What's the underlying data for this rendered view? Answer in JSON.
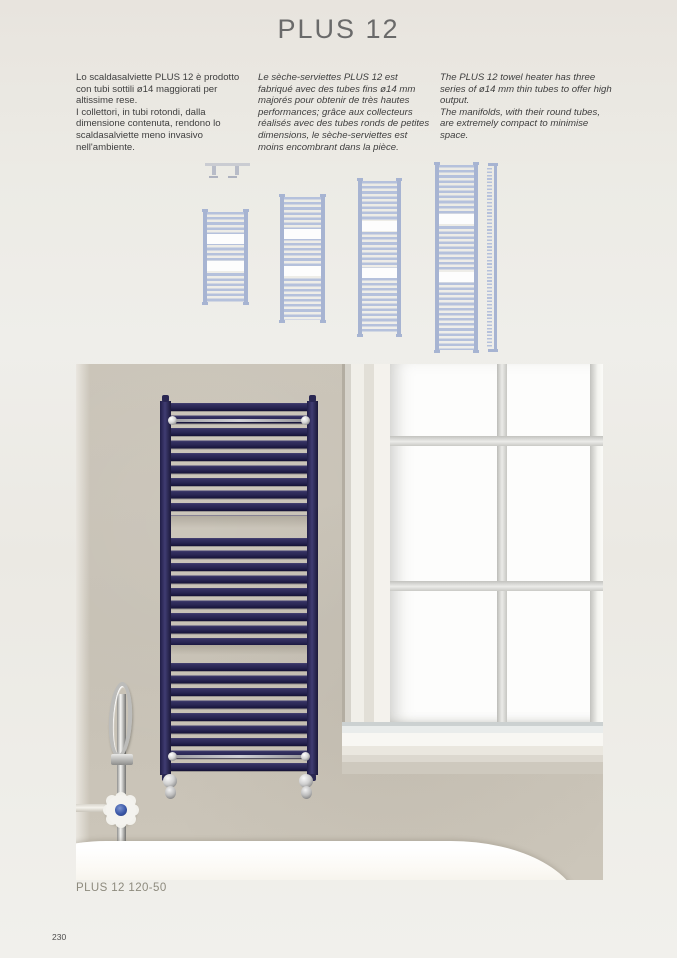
{
  "page": {
    "title": "PLUS 12",
    "caption": "PLUS 12 120-50",
    "page_number": "230"
  },
  "intro": {
    "italian": "Lo scaldasalviette PLUS 12 è prodotto con tubi sottili ø14 maggiorati per altissime rese.\nI collettori, in tubi rotondi, dalla dimensione contenuta, rendono lo scaldasalviette meno invasivo nell'ambiente.",
    "french": "Le sèche-serviettes PLUS 12 est fabriqué avec des tubes fins ø14 mm majorés pour obtenir de très hautes performances; grâce aux collecteurs réalisés avec des tubes ronds de petites dimensions, le sèche-serviettes est moins encombrant dans la pièce.",
    "english": "The PLUS 12 towel heater has three series of ø14 mm thin tubes to offer high output.\nThe manifolds, with their round tubes, are extremely compact to minimise space."
  },
  "colors": {
    "title_text": "#6a6a6a",
    "body_text": "#3e3e3e",
    "caption_text": "#8d8a7d",
    "drawing_blue": "#b5c1dc",
    "drawing_rail": "#a7b4d2",
    "radiator_navy": "#2e2b57",
    "wall_beige": "#c7c1b5",
    "window_white": "#fdfdfc",
    "tub_white": "#faf8f3",
    "chrome": "#c9c9c9"
  }
}
